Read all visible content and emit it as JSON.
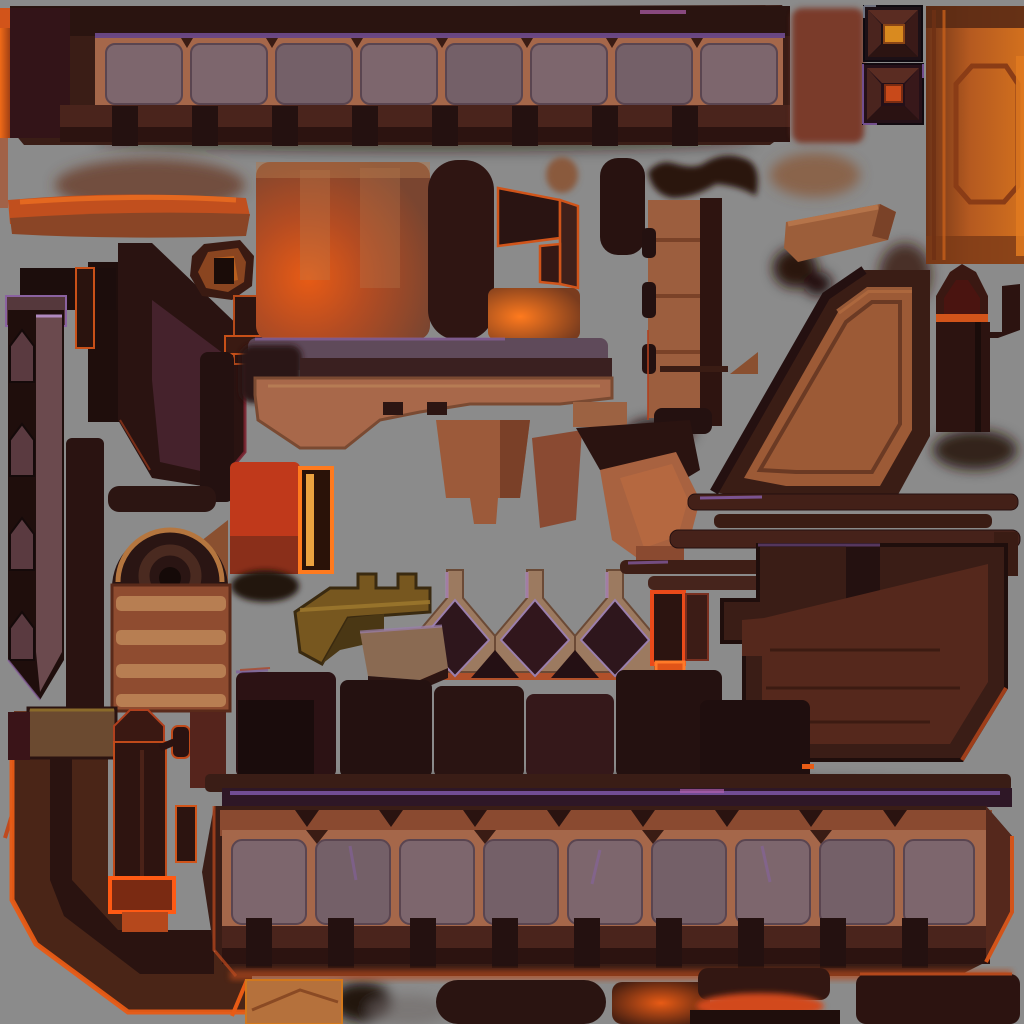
{
  "scene": {
    "kind": "game-texture-atlas",
    "label": "hell-forge architecture sprite sheet",
    "background_color": "#8b8b8b"
  },
  "palette": {
    "background": "#8b8b8b",
    "frame_dark": "#3a1d16",
    "frame_darkest": "#241110",
    "beam_tan": "#a5674a",
    "stone_panel": "#7d666d",
    "purple_accent": "#7e57a8",
    "magenta_glint": "#b05fae",
    "orange_glow": "#e85b15",
    "orange_bright": "#ff7a1e",
    "ember_red": "#c0391b",
    "gold_core": "#d98a1f",
    "ember_core": "#c8491a",
    "column_orange": "#b55a20",
    "clay": "#9c5a36",
    "rust_light": "#b5713c",
    "mauve": "#6b4a4e",
    "maroon_face": "#45222c",
    "wood_panel": "#55281c",
    "olive_gold": "#77571f",
    "stripe_tan": "#bf8758"
  },
  "sprites": [
    {
      "name": "top-stone-beam",
      "label": "long bridge beam with stone panels"
    },
    {
      "name": "gem-button-gold",
      "label": "square socket, gold core"
    },
    {
      "name": "gem-button-ember",
      "label": "square socket, ember core"
    },
    {
      "name": "orange-column",
      "label": "tall orange column with octagon panel"
    },
    {
      "name": "red-block",
      "label": "soft red block"
    },
    {
      "name": "orange-plank",
      "label": "glowing plank"
    },
    {
      "name": "dark-boot-slab",
      "label": "angular dark slab"
    },
    {
      "name": "octagon-nut",
      "label": "faceted ring nut"
    },
    {
      "name": "spike-strip",
      "label": "left chevron spike strip"
    },
    {
      "name": "glow-slab",
      "label": "furnace-lit slab"
    },
    {
      "name": "dark-pill",
      "label": "dark rounded slab"
    },
    {
      "name": "flag-bracket",
      "label": "orange-edged angled bracket"
    },
    {
      "name": "glow-box",
      "label": "small glowing box"
    },
    {
      "name": "ledge-key",
      "label": "stepped ledge with purple cap"
    },
    {
      "name": "segmented-column",
      "label": "segmented pillar with pegs"
    },
    {
      "name": "saddle-blob",
      "label": "dark saddle"
    },
    {
      "name": "tilted-plank",
      "label": "tilted plank"
    },
    {
      "name": "diagonal-ramp",
      "label": "framed diagonal ramp"
    },
    {
      "name": "pointed-tower",
      "label": "arched tower with arm"
    },
    {
      "name": "hanging-buckets",
      "label": "trapezoid bucket pieces"
    },
    {
      "name": "ember-block",
      "label": "saturated ember block"
    },
    {
      "name": "glowing-stick",
      "label": "orange rimmed stick"
    },
    {
      "name": "striped-crate",
      "label": "banded crate"
    },
    {
      "name": "wheel-arch",
      "label": "half wheel arch"
    },
    {
      "name": "dark-pillars",
      "label": "dark vertical pillars"
    },
    {
      "name": "gold-key",
      "label": "olive key piece"
    },
    {
      "name": "crown-diamonds",
      "label": "triple peak crown with diamond insets"
    },
    {
      "name": "wing-ledge",
      "label": "small wing ledge"
    },
    {
      "name": "orange-frame-boxes",
      "label": "orange framed boxes"
    },
    {
      "name": "rod-stack",
      "label": "thin stacked rods"
    },
    {
      "name": "l-panel",
      "label": "large stepped wooden panel"
    },
    {
      "name": "dark-block-row",
      "label": "row of dark blocks"
    },
    {
      "name": "corner-frame",
      "label": "bottom-left rim-lit corner frame"
    },
    {
      "name": "lever-tower",
      "label": "small tower with lever arm"
    },
    {
      "name": "bottom-stone-beam",
      "label": "long bridge beam with stone panels"
    },
    {
      "name": "under-strip-box",
      "label": "tan box"
    },
    {
      "name": "under-strip-pill",
      "label": "dark pill"
    },
    {
      "name": "under-strip-glow",
      "label": "ember glow strip"
    },
    {
      "name": "edge-glow-left",
      "label": "hot left edge glow"
    }
  ]
}
